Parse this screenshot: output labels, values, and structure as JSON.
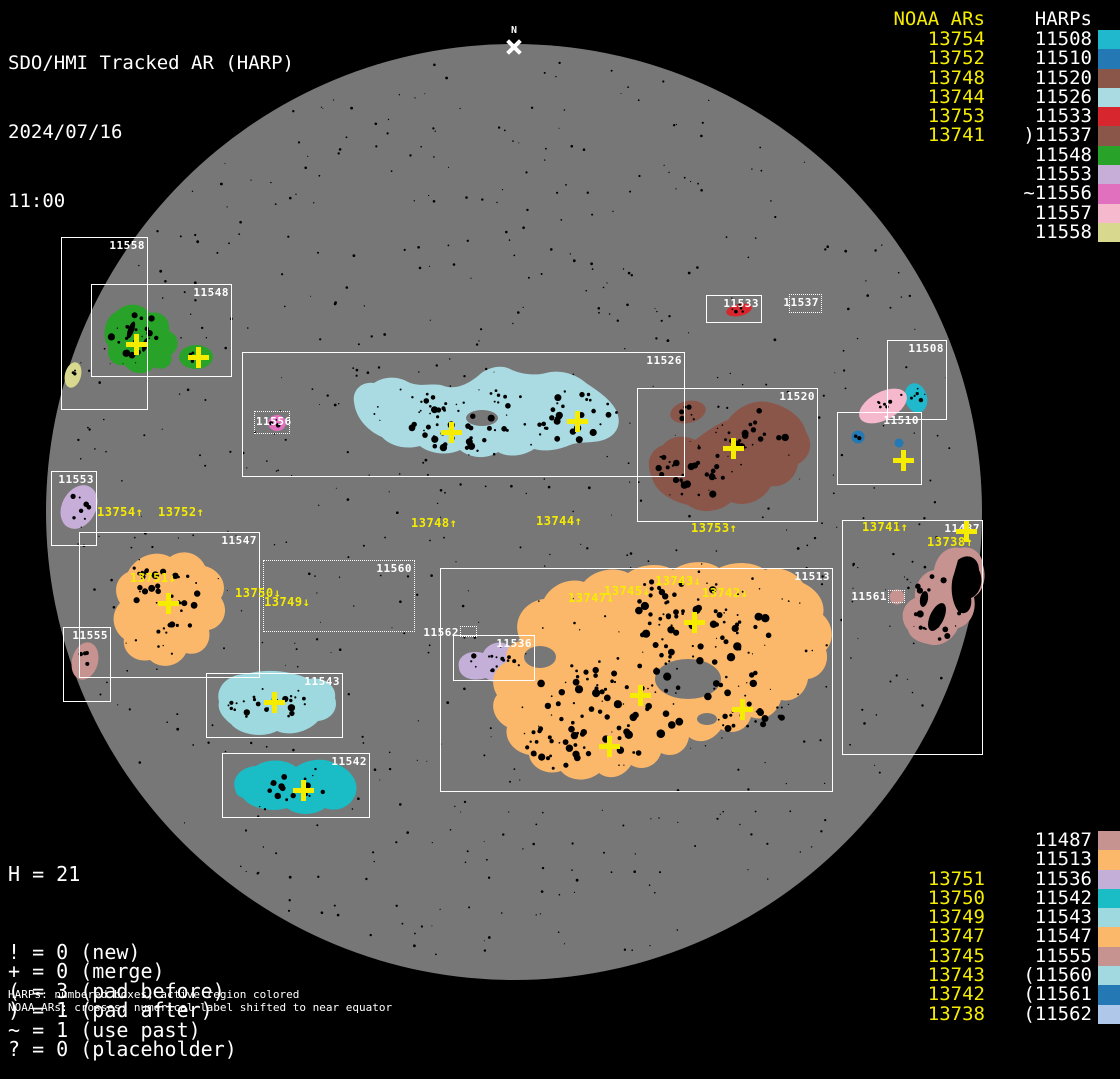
{
  "header": {
    "title": "SDO/HMI Tracked AR (HARP)",
    "date": "2024/07/16",
    "time": "11:00"
  },
  "north_marker": {
    "label": "N"
  },
  "legend_top": {
    "noaa_header": "NOAA ARs",
    "harps_header": "HARPs",
    "rows": [
      {
        "noaa": "13754",
        "harp": "11508",
        "color": "#20b8cc"
      },
      {
        "noaa": "13752",
        "harp": "11510",
        "color": "#2478b4"
      },
      {
        "noaa": "13748",
        "harp": "11520",
        "color": "#8b564a"
      },
      {
        "noaa": "13744",
        "harp": "11526",
        "color": "#aadbe2"
      },
      {
        "noaa": "13753",
        "harp": "11533",
        "color": "#d8262e"
      },
      {
        "noaa": "13741",
        "harp": ")11537",
        "color": "#8b564a"
      },
      {
        "noaa": "",
        "harp": "11548",
        "color": "#28a228"
      },
      {
        "noaa": "",
        "harp": "11553",
        "color": "#c7aed8"
      },
      {
        "noaa": "",
        "harp": "~11556",
        "color": "#e170bf"
      },
      {
        "noaa": "",
        "harp": "11557",
        "color": "#f5b8cd"
      },
      {
        "noaa": "",
        "harp": "11558",
        "color": "#d9d88f"
      }
    ]
  },
  "legend_bottom": {
    "rows": [
      {
        "noaa": "",
        "harp": "11487",
        "color": "#c79390"
      },
      {
        "noaa": "",
        "harp": "11513",
        "color": "#fbb86b"
      },
      {
        "noaa": "13751",
        "harp": "11536",
        "color": "#c4afd9"
      },
      {
        "noaa": "13750",
        "harp": "11542",
        "color": "#1abcc6"
      },
      {
        "noaa": "13749",
        "harp": "11543",
        "color": "#9ed9e0"
      },
      {
        "noaa": "13747",
        "harp": "11547",
        "color": "#fbb86b"
      },
      {
        "noaa": "13745",
        "harp": "11555",
        "color": "#c79390"
      },
      {
        "noaa": "13743",
        "harp": "(11560",
        "color": "#a2d9e0"
      },
      {
        "noaa": "13742",
        "harp": "(11561",
        "color": "#2478b4"
      },
      {
        "noaa": "13738",
        "harp": "(11562",
        "color": "#afc7e9"
      }
    ]
  },
  "stats": {
    "h_line": "H = 21",
    "lines": [
      "! = 0 (new)",
      "+ = 0 (merge)",
      "( = 3 (pad before)",
      ") = 1 (pad after)",
      "~ = 1 (use past)",
      "? = 0 (placeholder)"
    ]
  },
  "footnotes": [
    "HARPs: numbered boxes; active region colored",
    "NOAA ARs: crosses; numerical label shifted to near equator"
  ],
  "colors": {
    "background": "#000000",
    "disk": "#777777",
    "box_outline": "#ffffff",
    "noaa_label": "#f5ec00",
    "cross": "#f5ec00",
    "harp": {
      "11487": "#c79390",
      "11508": "#20b8cc",
      "11510": "#2478b4",
      "11513": "#fbb86b",
      "11520": "#8b564a",
      "11526": "#aadbe2",
      "11533": "#d8262e",
      "11536": "#c4afd9",
      "11537": "#8b564a",
      "11542": "#1abcc6",
      "11543": "#9ed9e0",
      "11547": "#fbb86b",
      "11548": "#28a228",
      "11553": "#c7aed8",
      "11555": "#c79390",
      "11556": "#e170bf",
      "11557": "#f5b8cd",
      "11558": "#d9d88f",
      "11560": "#a2d9e0",
      "11561": "#2478b4",
      "11562": "#afc7e9"
    }
  },
  "chart_data": {
    "type": "table",
    "title": "SDO/HMI Tracked AR (HARP) full-disk map, 2024/07/16 11:00",
    "harp_boxes": [
      {
        "harp": "11558",
        "x": 61,
        "y": 237,
        "w": 87,
        "h": 173,
        "style": "solid"
      },
      {
        "harp": "11548",
        "x": 91,
        "y": 284,
        "w": 141,
        "h": 93,
        "style": "solid"
      },
      {
        "harp": "11526",
        "x": 242,
        "y": 352,
        "w": 443,
        "h": 125,
        "style": "solid"
      },
      {
        "harp": "11556",
        "x": 254,
        "y": 411,
        "w": 36,
        "h": 23,
        "style": "dotted",
        "label_pos": "inside-left"
      },
      {
        "harp": "11533",
        "x": 706,
        "y": 295,
        "w": 56,
        "h": 28,
        "style": "solid"
      },
      {
        "harp": "11537",
        "x": 789,
        "y": 294,
        "w": 33,
        "h": 19,
        "style": "dotted"
      },
      {
        "harp": "11520",
        "x": 637,
        "y": 388,
        "w": 181,
        "h": 134,
        "style": "solid"
      },
      {
        "harp": "11508",
        "x": 887,
        "y": 340,
        "w": 60,
        "h": 80,
        "style": "solid"
      },
      {
        "harp": "11510",
        "x": 837,
        "y": 412,
        "w": 85,
        "h": 73,
        "style": "solid"
      },
      {
        "harp": "11553",
        "x": 51,
        "y": 471,
        "w": 46,
        "h": 75,
        "style": "solid"
      },
      {
        "harp": "11547",
        "x": 79,
        "y": 532,
        "w": 181,
        "h": 146,
        "style": "solid"
      },
      {
        "harp": "11555",
        "x": 63,
        "y": 627,
        "w": 48,
        "h": 75,
        "style": "solid"
      },
      {
        "harp": "11560",
        "x": 263,
        "y": 560,
        "w": 152,
        "h": 72,
        "style": "dotted"
      },
      {
        "harp": "11543",
        "x": 206,
        "y": 673,
        "w": 137,
        "h": 65,
        "style": "solid"
      },
      {
        "harp": "11542",
        "x": 222,
        "y": 753,
        "w": 148,
        "h": 65,
        "style": "solid"
      },
      {
        "harp": "11562",
        "x": 460,
        "y": 626,
        "w": 17,
        "h": 11,
        "style": "dotted",
        "label_pos": "outside-left"
      },
      {
        "harp": "11536",
        "x": 453,
        "y": 635,
        "w": 82,
        "h": 46,
        "style": "solid"
      },
      {
        "harp": "11513",
        "x": 440,
        "y": 568,
        "w": 393,
        "h": 224,
        "style": "solid"
      },
      {
        "harp": "11487",
        "x": 842,
        "y": 520,
        "w": 141,
        "h": 235,
        "style": "solid"
      },
      {
        "harp": "11561",
        "x": 888,
        "y": 590,
        "w": 17,
        "h": 13,
        "style": "dotted",
        "label_pos": "outside-left"
      }
    ],
    "noaa_crosses": [
      {
        "x": 136,
        "y": 344
      },
      {
        "x": 198,
        "y": 357
      },
      {
        "x": 451,
        "y": 432
      },
      {
        "x": 577,
        "y": 421
      },
      {
        "x": 733,
        "y": 448
      },
      {
        "x": 903,
        "y": 460
      },
      {
        "x": 168,
        "y": 603
      },
      {
        "x": 274,
        "y": 702
      },
      {
        "x": 303,
        "y": 790
      },
      {
        "x": 694,
        "y": 622
      },
      {
        "x": 640,
        "y": 695
      },
      {
        "x": 742,
        "y": 709
      },
      {
        "x": 609,
        "y": 746
      },
      {
        "x": 966,
        "y": 531
      }
    ],
    "noaa_labels": [
      {
        "text": "13754↑",
        "x": 97,
        "y": 505
      },
      {
        "text": "13752↑",
        "x": 158,
        "y": 505
      },
      {
        "text": "13748↑",
        "x": 411,
        "y": 516
      },
      {
        "text": "13744↑",
        "x": 536,
        "y": 514
      },
      {
        "text": "13753↑",
        "x": 691,
        "y": 521
      },
      {
        "text": "13741↑",
        "x": 862,
        "y": 520
      },
      {
        "text": "13738↑",
        "x": 927,
        "y": 535
      },
      {
        "text": "13751↓",
        "x": 130,
        "y": 571
      },
      {
        "text": "13750↓",
        "x": 235,
        "y": 586
      },
      {
        "text": "13749↓",
        "x": 264,
        "y": 595
      },
      {
        "text": "13747↓",
        "x": 568,
        "y": 591
      },
      {
        "text": "13745↓",
        "x": 604,
        "y": 584
      },
      {
        "text": "13743↓",
        "x": 655,
        "y": 574
      },
      {
        "text": "13742↓",
        "x": 702,
        "y": 586
      }
    ]
  }
}
